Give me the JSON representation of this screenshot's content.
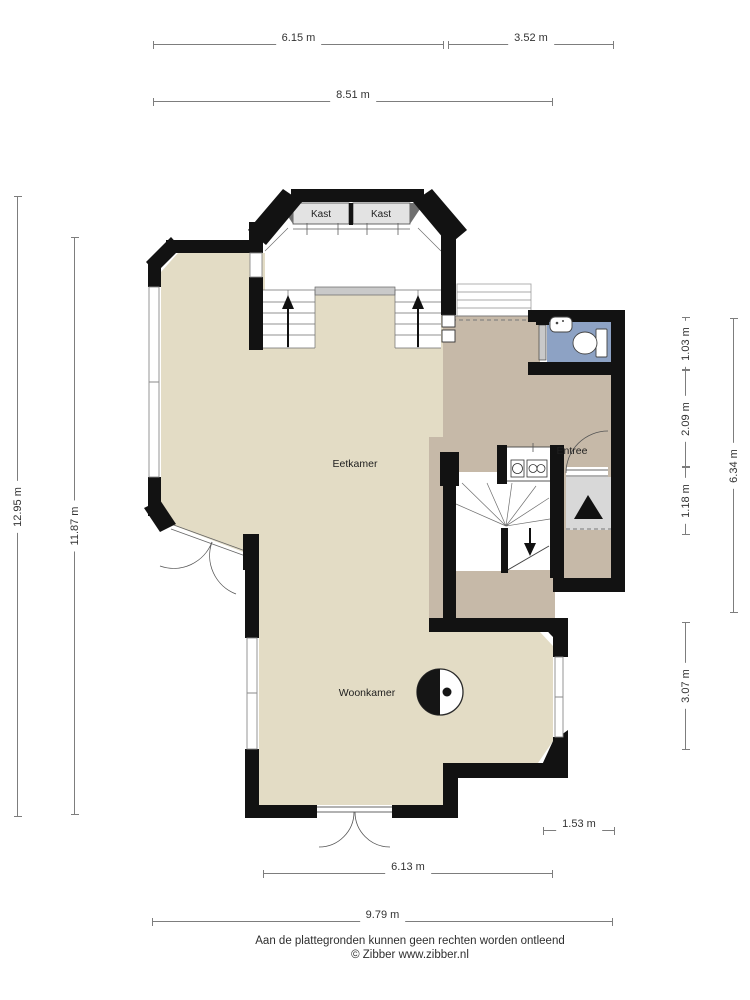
{
  "rooms": {
    "closet_left": "Kast",
    "closet_right": "Kast",
    "dining": "Eetkamer",
    "living": "Woonkamer",
    "entry": "Entree"
  },
  "dimensions": {
    "top_left": "6.15 m",
    "top_right": "3.52 m",
    "top_total": "8.51 m",
    "left_outer": "12.95 m",
    "left_inner": "11.87 m",
    "right_toilet": "1.03 m",
    "right_hall": "2.09 m",
    "right_porch": "1.18 m",
    "right_total": "6.34 m",
    "right_living": "3.07 m",
    "bottom_porch": "1.53 m",
    "bottom_living": "6.13 m",
    "bottom_total": "9.79 m"
  },
  "footer": {
    "disclaimer": "Aan de plattegronden kunnen geen rechten worden ontleend",
    "copyright": "© Zibber www.zibber.nl"
  },
  "colors": {
    "floor_main": "#e3dcc5",
    "floor_hall": "#c6b9a8",
    "floor_toilet": "#8da2c4",
    "floor_closet": "#e3e3e3",
    "floor_porch": "#d8d8d8",
    "wall": "#121212"
  }
}
